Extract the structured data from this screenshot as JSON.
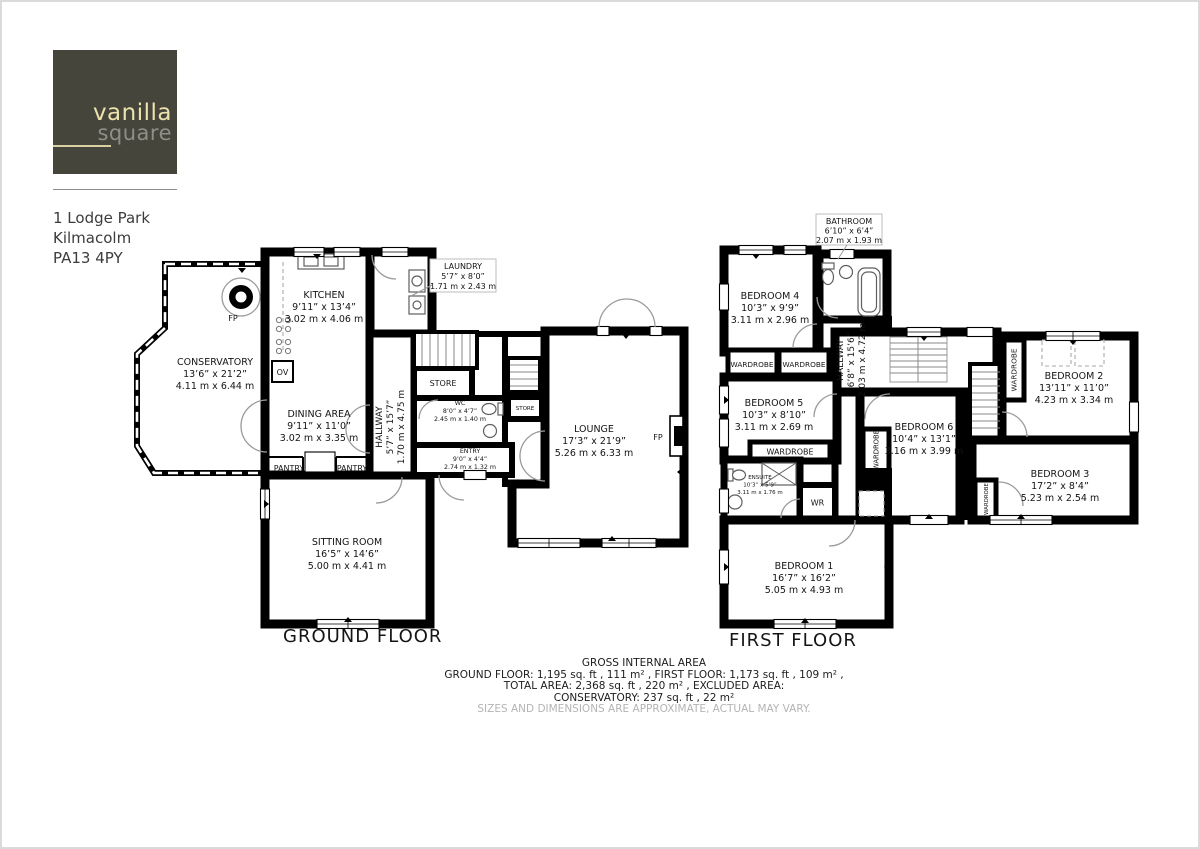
{
  "brand": {
    "name_top": "vanilla",
    "name_bottom": "square"
  },
  "address": {
    "line1": "1 Lodge Park",
    "line2": "Kilmacolm",
    "line3": "PA13 4PY"
  },
  "ground_floor": {
    "title": "GROUND FLOOR",
    "rooms": {
      "conservatory": {
        "name": "CONSERVATORY",
        "imperial": "13’6” x 21’2”",
        "metric": "4.11 m x 6.44 m"
      },
      "kitchen": {
        "name": "KITCHEN",
        "imperial": "9’11” x 13’4”",
        "metric": "3.02 m x 4.06 m"
      },
      "laundry": {
        "name": "LAUNDRY",
        "imperial": "5’7” x 8’0”",
        "metric": "1.71 m x 2.43 m"
      },
      "dining": {
        "name": "DINING AREA",
        "imperial": "9’11” x 11’0”",
        "metric": "3.02 m x 3.35 m"
      },
      "hallway": {
        "name": "HALLWAY",
        "imperial": "5’7” x 15’7”",
        "metric": "1.70 m x 4.75 m"
      },
      "wc": {
        "name": "WC",
        "imperial": "8’0” x 4’7”",
        "metric": "2.45 m x 1.40 m"
      },
      "entry": {
        "name": "ENTRY",
        "imperial": "9’0” x 4’4”",
        "metric": "2.74 m x 1.32 m"
      },
      "lounge": {
        "name": "LOUNGE",
        "imperial": "17’3” x 21’9”",
        "metric": "5.26 m x 6.33 m"
      },
      "sitting": {
        "name": "SITTING ROOM",
        "imperial": "16’5” x 14’6”",
        "metric": "5.00 m x 4.41 m"
      }
    },
    "small_labels": {
      "store": "STORE",
      "pantry": "PANTRY",
      "oven": "OV",
      "fireplace": "FP"
    }
  },
  "first_floor": {
    "title": "FIRST FLOOR",
    "rooms": {
      "bathroom": {
        "name": "BATHROOM",
        "imperial": "6’10” x 6’4”",
        "metric": "2.07 m x 1.93 m"
      },
      "bedroom4": {
        "name": "BEDROOM 4",
        "imperial": "10’3” x 9’9”",
        "metric": "3.11 m x 2.96 m"
      },
      "bedroom5": {
        "name": "BEDROOM 5",
        "imperial": "10’3” x 8’10”",
        "metric": "3.11 m x 2.69 m"
      },
      "hallway": {
        "name": "HALLWAY",
        "imperial": "6’8” x 15’6”",
        "metric": "2.03 m x 4.72 m"
      },
      "ensuite": {
        "name": "ENSUITE",
        "imperial": "10’3” x 5’9”",
        "metric": "3.11 m x 1.76 m"
      },
      "bedroom6": {
        "name": "BEDROOM 6",
        "imperial": "10’4” x 13’1”",
        "metric": "3.16 m x 3.99 m"
      },
      "bedroom2": {
        "name": "BEDROOM 2",
        "imperial": "13’11” x 11’0”",
        "metric": "4.23 m x 3.34 m"
      },
      "bedroom3": {
        "name": "BEDROOM 3",
        "imperial": "17’2” x 8’4”",
        "metric": "5.23 m x 2.54 m"
      },
      "bedroom1": {
        "name": "BEDROOM 1",
        "imperial": "16’7” x 16’2”",
        "metric": "5.05 m x 4.93 m"
      }
    },
    "small_labels": {
      "wardrobe": "WARDROBE",
      "wr": "WR"
    }
  },
  "footer": {
    "title": "GROSS INTERNAL AREA",
    "line1": "GROUND FLOOR: 1,195 sq. ft , 111 m² , FIRST FLOOR: 1,173 sq. ft , 109 m² ,",
    "line2": "TOTAL AREA: 2,368 sq. ft , 220 m² , EXCLUDED AREA:",
    "line3": "CONSERVATORY: 237 sq. ft , 22 m²",
    "disclaimer": "SIZES AND DIMENSIONS ARE APPROXIMATE, ACTUAL MAY VARY."
  }
}
